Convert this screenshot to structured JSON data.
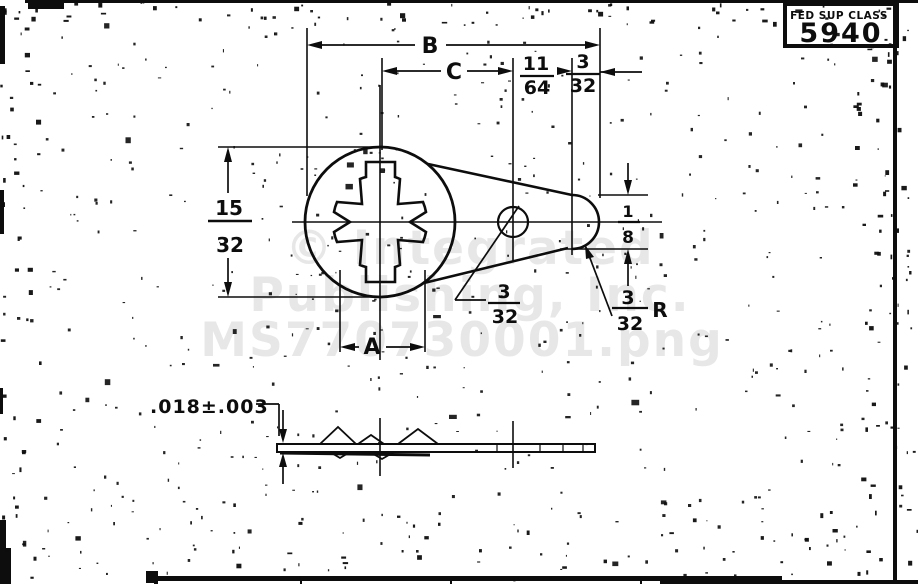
{
  "stamp": {
    "label": "FED SUP CLASS",
    "number": "5940"
  },
  "watermark": {
    "line1": "© Integrated",
    "line2": "Publishing, Inc.",
    "line3": "MS770730001.png"
  },
  "top_view": {
    "dim_overall_length": "B",
    "dim_center_to_hole": "C",
    "dim_hole_to_tip": {
      "num": "11",
      "den": "64"
    },
    "dim_tip_offset": {
      "num": "3",
      "den": "32"
    },
    "dim_outside_diameter": {
      "num": "15",
      "den": "32"
    },
    "dim_bore_width": "A",
    "dim_tip_height": {
      "num": "1",
      "den": "8"
    },
    "dim_hole_diameter": {
      "num": "3",
      "den": "32"
    },
    "dim_tip_radius": {
      "num": "3",
      "den": "32",
      "suffix": "R"
    }
  },
  "side_view": {
    "dim_thickness": ".018±.003"
  },
  "colors": {
    "ink": "#0d0d0d",
    "paper": "#ffffff",
    "watermark": "#e7e7e7"
  }
}
